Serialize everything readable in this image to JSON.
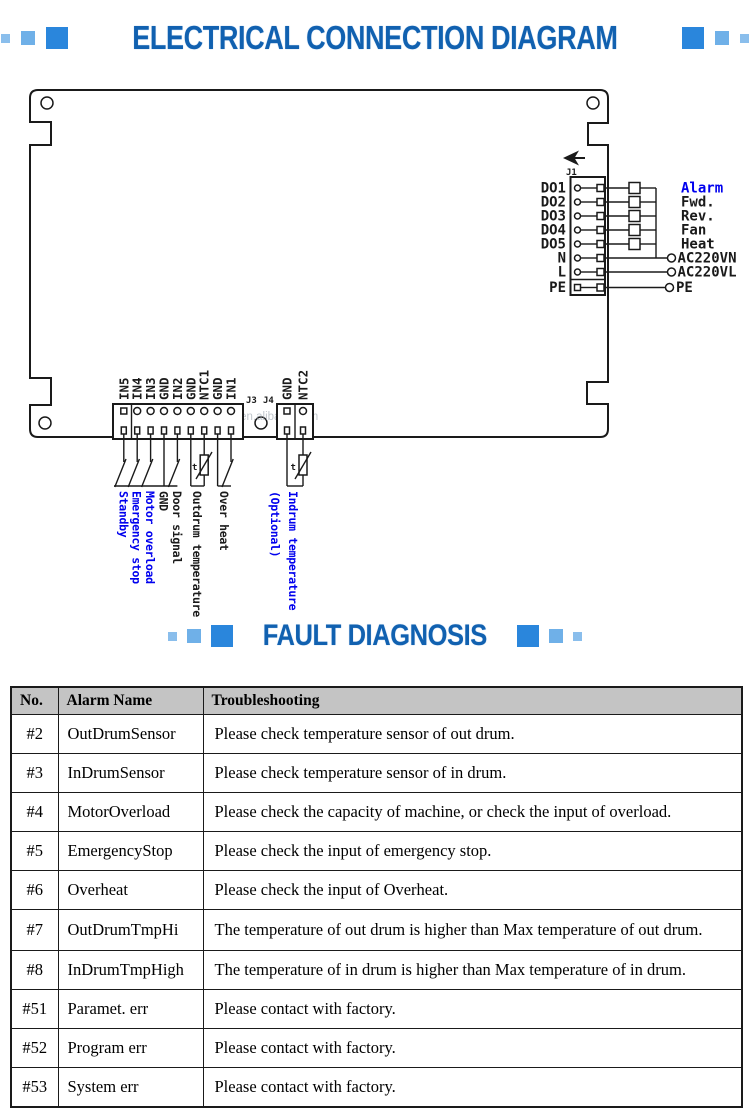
{
  "titles": {
    "electrical": "ELECTRICAL CONNECTION DIAGRAM",
    "fault": "FAULT DIAGNOSIS"
  },
  "colors": {
    "title_blue": "#1161b0",
    "sq_large": "#2a86dc",
    "sq_med": "#6fb0e8",
    "sq_small": "#8abeec",
    "schem_blue": "#0000ee",
    "ink": "#1a1a1a",
    "header_bg": "#c4c4c4",
    "watermark": "#9aa4ae"
  },
  "diagram": {
    "watermark": "https://tzjiefan.en.alibaba.com",
    "thermistor": "t",
    "j1": {
      "label": "J1",
      "pins": [
        "DO1",
        "DO2",
        "DO3",
        "DO4",
        "DO5",
        "N",
        "L",
        "PE"
      ],
      "outputs": [
        "Alarm",
        "Fwd.",
        "Rev.",
        "Fan",
        "Heat"
      ],
      "power": [
        "AC220VN",
        "AC220VL",
        "PE"
      ]
    },
    "j3": {
      "label": "J3",
      "pins": [
        "IN5",
        "IN4",
        "IN3",
        "GND",
        "IN2",
        "GND",
        "NTC1",
        "GND",
        "IN1"
      ]
    },
    "j4": {
      "label": "J4",
      "pins": [
        "GND",
        "NTC2"
      ]
    },
    "inputs": {
      "standby": "Standby",
      "emergency": "Emergency stop",
      "motor": "Motor overload",
      "gnd": "GND",
      "door": "Door signal",
      "outdrum": "Outdrum temperature",
      "overheat": "Over heat",
      "indrum": "Indrum temperature",
      "optional": "(Optional)"
    }
  },
  "table": {
    "headers": [
      "No.",
      "Alarm Name",
      "Troubleshooting"
    ],
    "rows": [
      {
        "no": "#2",
        "name": "OutDrumSensor",
        "tip": "Please check temperature sensor of out drum."
      },
      {
        "no": "#3",
        "name": "InDrumSensor",
        "tip": "Please check temperature sensor of in drum."
      },
      {
        "no": "#4",
        "name": "MotorOverload",
        "tip": "Please check the capacity of machine, or check the input of overload."
      },
      {
        "no": "#5",
        "name": "EmergencyStop",
        "tip": "Please check the input of emergency stop."
      },
      {
        "no": "#6",
        "name": "Overheat",
        "tip": "Please check the input of Overheat."
      },
      {
        "no": "#7",
        "name": "OutDrumTmpHi",
        "tip": "The temperature of out drum is higher than Max temperature of out drum."
      },
      {
        "no": "#8",
        "name": "InDrumTmpHigh",
        "tip": "The temperature of in drum is higher than Max temperature of in drum."
      },
      {
        "no": "#51",
        "name": "Paramet. err",
        "tip": "Please contact with factory."
      },
      {
        "no": "#52",
        "name": "Program err",
        "tip": "Please contact with factory."
      },
      {
        "no": "#53",
        "name": "System err",
        "tip": "Please contact with factory."
      }
    ]
  }
}
